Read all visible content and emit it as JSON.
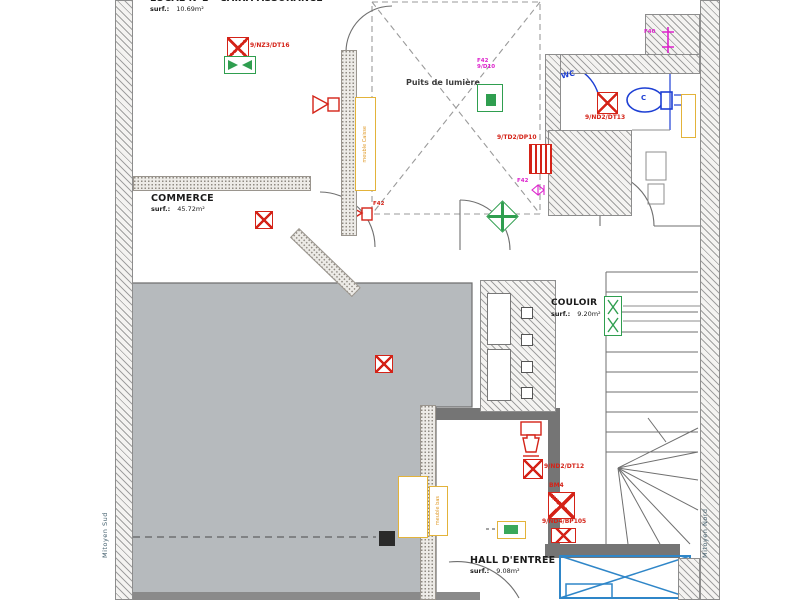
{
  "rooms": {
    "local": {
      "title": "LOCAL N°1 - CAIXA ASSURANCE",
      "surf_label": "surf.:",
      "area": "10.69m²"
    },
    "commerce": {
      "title": "COMMERCE",
      "surf_label": "surf.:",
      "area": "45.72m²"
    },
    "couloir": {
      "title": "COULOIR",
      "surf_label": "surf.:",
      "area": "9.20m²"
    },
    "hall": {
      "title": "HALL D'ENTREE",
      "surf_label": "surf.:",
      "area": "9.08m²"
    },
    "puits": {
      "title": "Puits de lumière"
    }
  },
  "party_walls": {
    "south": "Mitoyen Sud",
    "north": "Mitoyen Nord"
  },
  "equipment_tags": {
    "dt16": "9/NZ3/DT16",
    "dt13": "9/ND2/DT13",
    "dp10": "9/TD2/DP10",
    "dt12": "9/ND2/DT12",
    "bm4": "BM4",
    "bp105": "9/ND4/BP105"
  },
  "fixture_labels": {
    "f40": "F40",
    "f42_puits": "F42",
    "d10_puits": "9/D10",
    "f42_couloir": "F42",
    "f42_commerce": "F42",
    "wc": "WC",
    "wc_c": "C",
    "meuble_caisse": "meuble Caisse",
    "meuble_bas": "meuble bas"
  },
  "colors": {
    "floor_gray": "#b6babd",
    "tag_red": "#d42318",
    "green": "#2f9e4f",
    "yellow": "#e3b33a",
    "magenta": "#dd22cc",
    "blue": "#1d3fd4",
    "elevator_blue": "#2f86c8"
  }
}
